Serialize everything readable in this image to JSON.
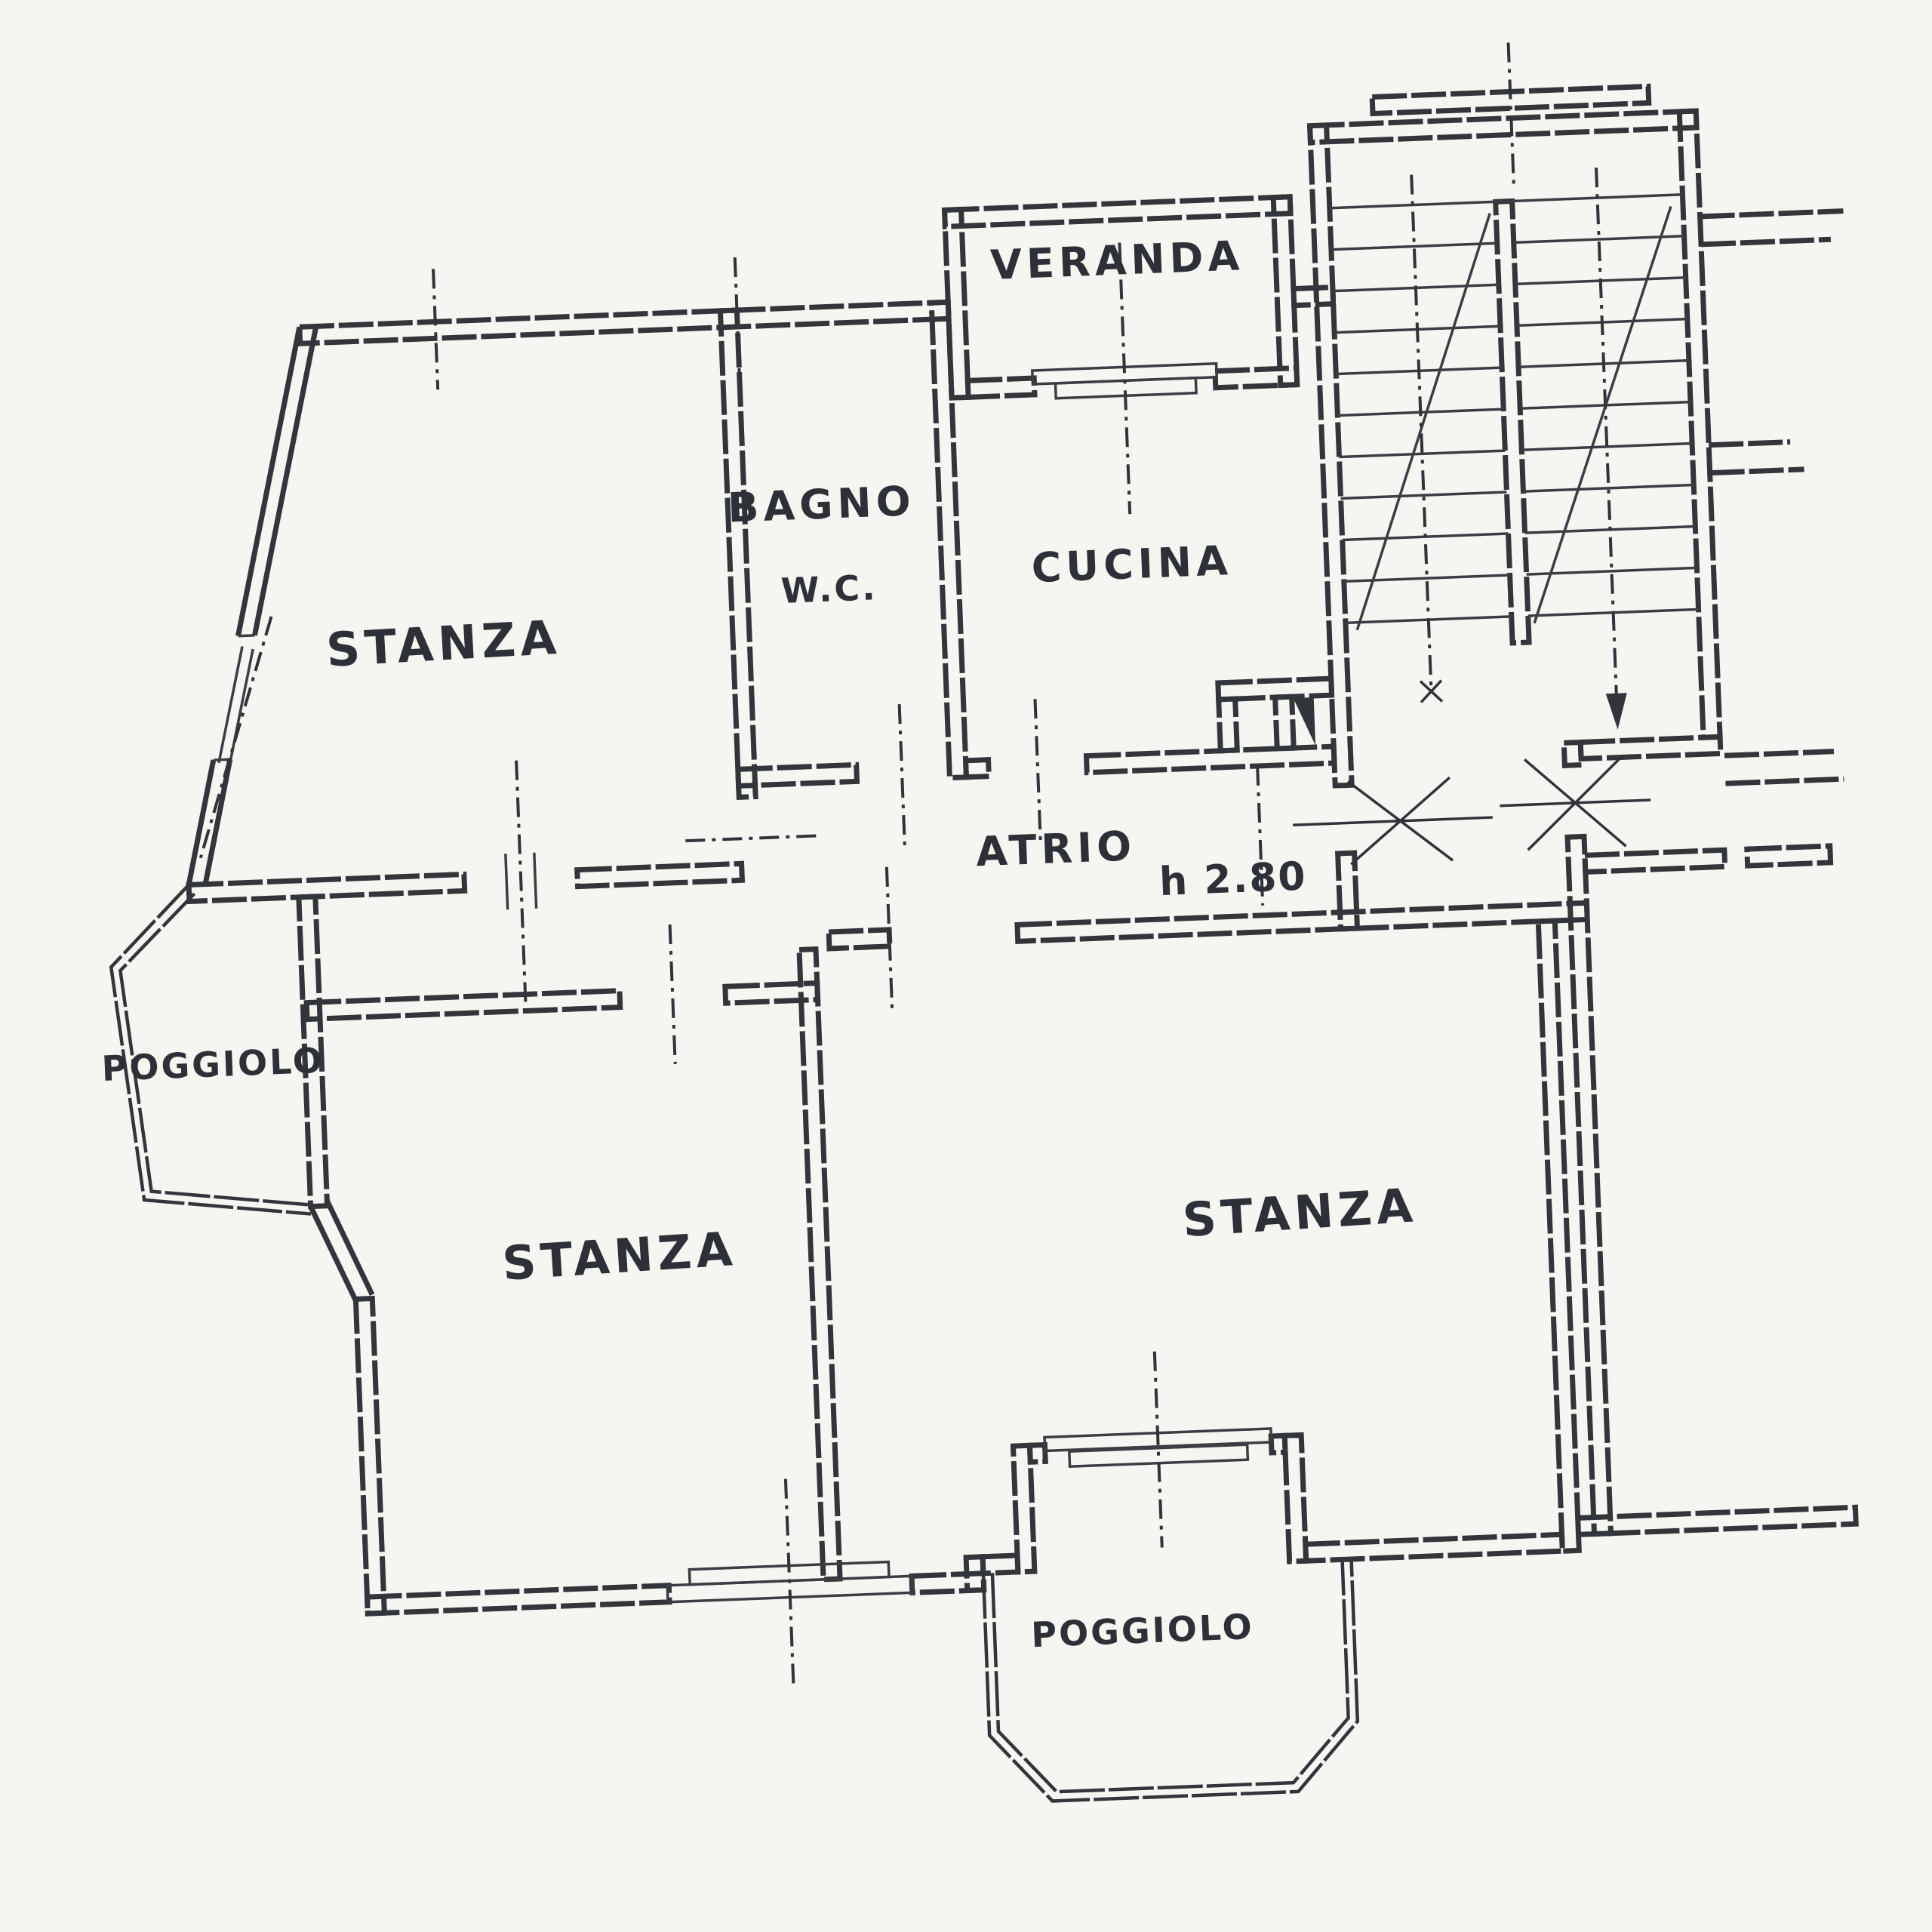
{
  "document": {
    "type": "scanned-floor-plan",
    "style": "hand-drawn architectural sketch, photocopy",
    "colors": {
      "ink": "#32353a",
      "paper": "#f5f5f2"
    }
  },
  "rooms": {
    "veranda": "VERANDA",
    "bagno": "BAGNO",
    "wc": "W.C.",
    "cucina": "CUCINA",
    "stanza_nw": "STANZA",
    "atrio": "ATRIO",
    "atrio_height": "h 2.80",
    "poggiolo_left": "POGGIOLO",
    "stanza_sw": "STANZA",
    "stanza_se": "STANZA",
    "poggiolo_bottom": "POGGIOLO"
  },
  "features": {
    "stairwell": "double-flight staircase with landing",
    "entrance_doors": "two door swings at stair landing",
    "shaft": "filled duct triangle beside cucina closet"
  }
}
